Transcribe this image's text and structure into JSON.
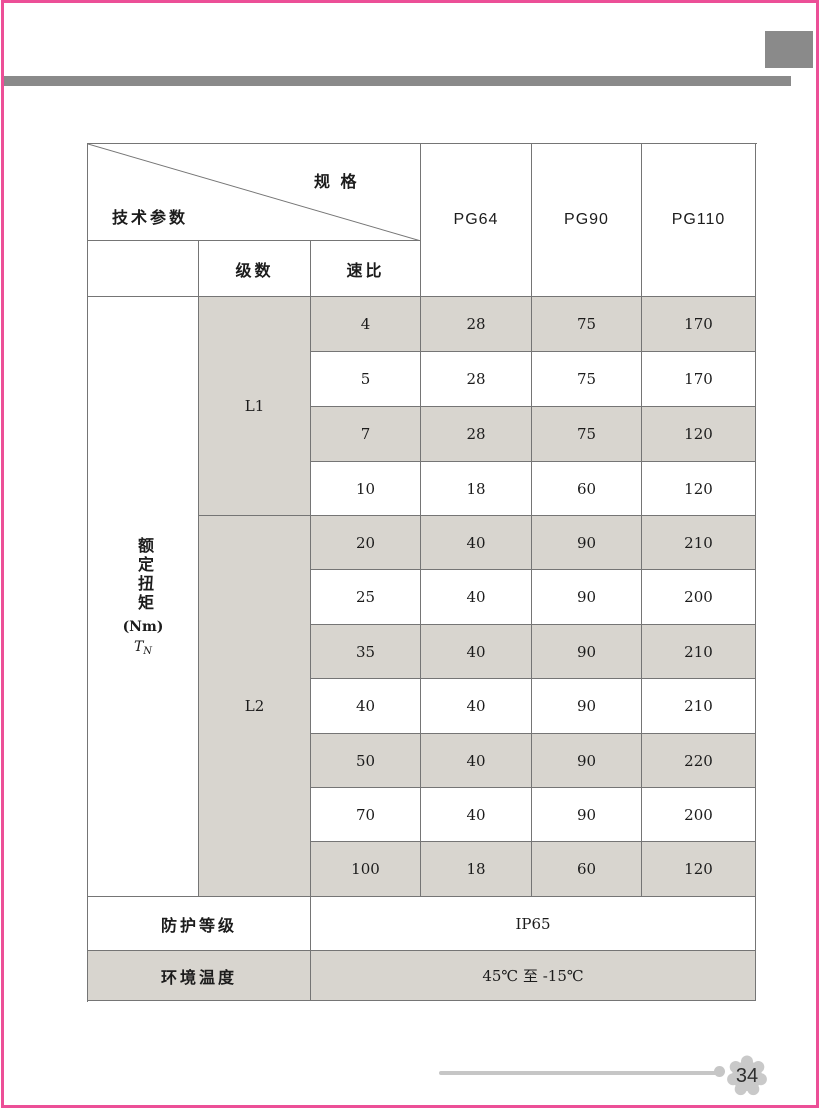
{
  "page": {
    "number": "34"
  },
  "colors": {
    "frame_pink": "#ec4f97",
    "accent_gray": "#8a8a8a",
    "row_shade": "#d8d5cf",
    "table_line": "#757575",
    "footer_gray": "#c6c6c6"
  },
  "table": {
    "corner": {
      "spec_label": "规 格",
      "params_label": "技术参数"
    },
    "columns": [
      "PG64",
      "PG90",
      "PG110"
    ],
    "stage_header": "级数",
    "ratio_header": "速比",
    "torque_header": {
      "vertical_text": "额定扭矩",
      "unit": "(Nm)",
      "symbol": "T",
      "symbol_sub": "N"
    },
    "groups": [
      {
        "stage": "L1",
        "rows": [
          {
            "ratio": "4",
            "pg64": "28",
            "pg90": "75",
            "pg110": "170"
          },
          {
            "ratio": "5",
            "pg64": "28",
            "pg90": "75",
            "pg110": "170"
          },
          {
            "ratio": "7",
            "pg64": "28",
            "pg90": "75",
            "pg110": "120"
          },
          {
            "ratio": "10",
            "pg64": "18",
            "pg90": "60",
            "pg110": "120"
          }
        ]
      },
      {
        "stage": "L2",
        "rows": [
          {
            "ratio": "20",
            "pg64": "40",
            "pg90": "90",
            "pg110": "210"
          },
          {
            "ratio": "25",
            "pg64": "40",
            "pg90": "90",
            "pg110": "200"
          },
          {
            "ratio": "35",
            "pg64": "40",
            "pg90": "90",
            "pg110": "210"
          },
          {
            "ratio": "40",
            "pg64": "40",
            "pg90": "90",
            "pg110": "210"
          },
          {
            "ratio": "50",
            "pg64": "40",
            "pg90": "90",
            "pg110": "220"
          },
          {
            "ratio": "70",
            "pg64": "40",
            "pg90": "90",
            "pg110": "200"
          },
          {
            "ratio": "100",
            "pg64": "18",
            "pg90": "60",
            "pg110": "120"
          }
        ]
      }
    ],
    "protection": {
      "label": "防护等级",
      "value": "IP65"
    },
    "temperature": {
      "label": "环境温度",
      "value": "45℃ 至 -15℃"
    }
  }
}
